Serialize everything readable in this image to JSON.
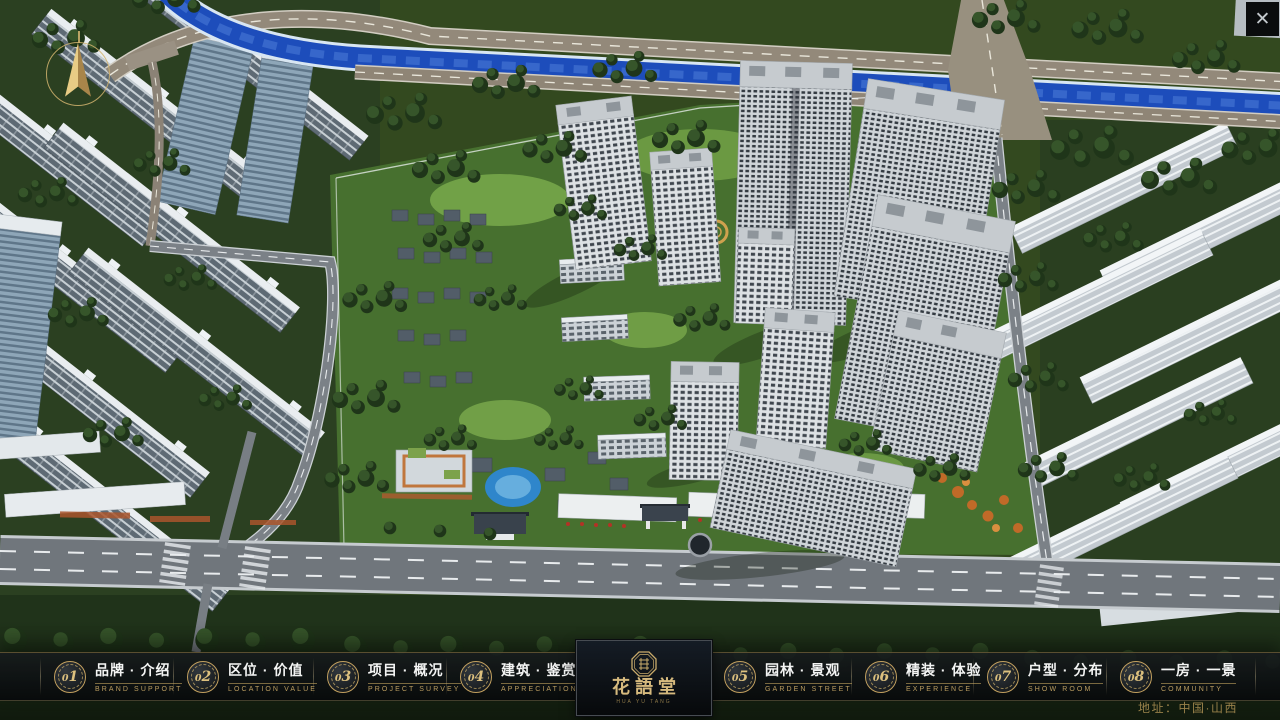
{
  "window": {
    "close_icon": "✕"
  },
  "nav": {
    "items": [
      {
        "num": "01",
        "zh": "品牌 · 介绍",
        "en": "BRAND SUPPORT"
      },
      {
        "num": "02",
        "zh": "区位 · 价值",
        "en": "LOCATION VALUE"
      },
      {
        "num": "03",
        "zh": "项目 · 概况",
        "en": "PROJECT SURVEY"
      },
      {
        "num": "04",
        "zh": "建筑 · 鉴赏",
        "en": "APPRECIATION"
      },
      {
        "num": "05",
        "zh": "园林 · 景观",
        "en": "GARDEN STREET"
      },
      {
        "num": "06",
        "zh": "精装 · 体验",
        "en": "EXPERIENCE"
      },
      {
        "num": "07",
        "zh": "户型 · 分布",
        "en": "SHOW ROOM"
      },
      {
        "num": "08",
        "zh": "一房 · 一景",
        "en": "COMMUNITY"
      }
    ]
  },
  "logo": {
    "title": "花語堂",
    "tagline": "HUA YU TANG"
  },
  "footer": {
    "address": "地址：中国·山西"
  },
  "colors": {
    "gold": "#c9ab6b",
    "river_blue": "#1d4dbb",
    "accent_red": "#b33226",
    "bar_bg": "rgba(8,10,12,0.9)"
  }
}
